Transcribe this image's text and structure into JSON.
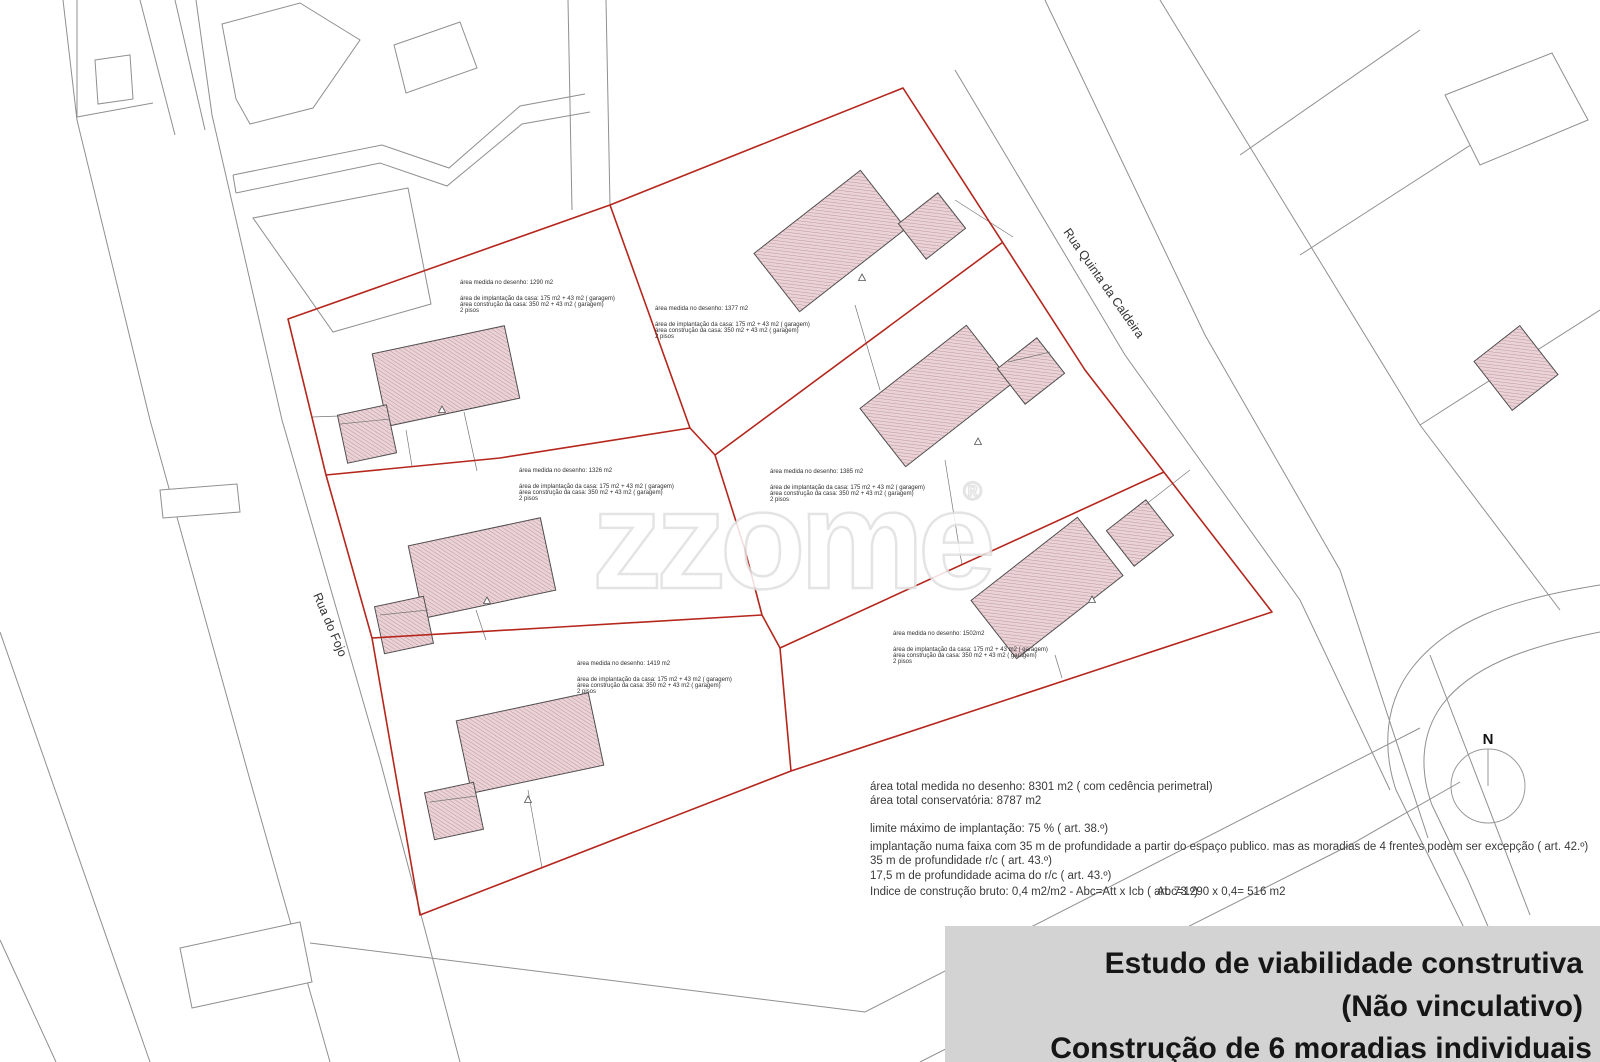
{
  "watermark": {
    "text": "zzome",
    "reg": "®"
  },
  "streets": {
    "left": "Rua do Fojo",
    "top_right": "Rua Quinta da Caldeira"
  },
  "north": {
    "label": "N"
  },
  "lots": [
    {
      "area_line": "área medida no desenho: 1290 m2",
      "implantacao": "área de implantação da casa: 175 m2 + 43 m2  ( garagem)",
      "construcao": "área construção da casa: 350 m2 + 43 m2  ( garagem)",
      "pisos": "2 pisos"
    },
    {
      "area_line": "área medida no desenho: 1377 m2",
      "implantacao": "área de implantação da casa: 175 m2 + 43 m2  ( garagem)",
      "construcao": "área construção da casa: 350 m2 + 43 m2  ( garagem)",
      "pisos": "2 pisos"
    },
    {
      "area_line": "área medida no desenho: 1326 m2",
      "implantacao": "área de implantação da casa: 175 m2 + 43 m2  ( garagem)",
      "construcao": "área construção da casa: 350 m2 + 43 m2  ( garagem)",
      "pisos": "2 pisos"
    },
    {
      "area_line": "área medida no desenho: 1385 m2",
      "implantacao": "área de implantação da casa: 175 m2 + 43 m2  ( garagem)",
      "construcao": "área construção da casa: 350 m2 + 43 m2  ( garagem)",
      "pisos": "2 pisos"
    },
    {
      "area_line": "área medida no desenho: 1419 m2",
      "implantacao": "área de implantação da casa: 175 m2 + 43 m2  ( garagem)",
      "construcao": "área construção da casa: 350 m2 + 43 m2  ( garagem)",
      "pisos": "2 pisos"
    },
    {
      "area_line": "área medida no desenho: 1502m2",
      "implantacao": "área de implantação da casa: 175 m2 + 43 m2  ( garagem)",
      "construcao": "área construção da casa: 350 m2 + 43 m2  ( garagem)",
      "pisos": "2 pisos"
    }
  ],
  "summary": {
    "total_desenho": "área total medida no desenho: 8301 m2  ( com cedência perimetral)",
    "total_conservatoria": "área total conservatória: 8787 m2",
    "limite": "limite máximo de implantação: 75 %  ( art. 38.º)",
    "faixa": "implantação numa faixa com 35 m de profundidade a partir do espaço publico. mas as moradias de 4 frentes podem ser excepção ( art. 42.º)",
    "profundidade_rc": "35 m de profundidade r/c  ( art. 43.º)",
    "profundidade_acima": "17,5 m de profundidade acima do r/c  ( art. 43.º)",
    "indice": "Indice de construção bruto: 0,4 m2/m2 - Abc=Att x Icb ( art. 73.º)",
    "abc": "Abc=1290 x 0,4= 516 m2"
  },
  "title_block": {
    "line1": "Estudo de viabilidade construtiva",
    "line2": "(Não vinculativo)",
    "line3": "Construção de 6 moradias individuais"
  },
  "colors": {
    "boundary_red": "#b5261c",
    "house_fill": "#ead3d7",
    "house_hatch": "#b5868e",
    "cadastre_gray": "#8f8f8f",
    "title_bg": "#d3d3d3"
  }
}
